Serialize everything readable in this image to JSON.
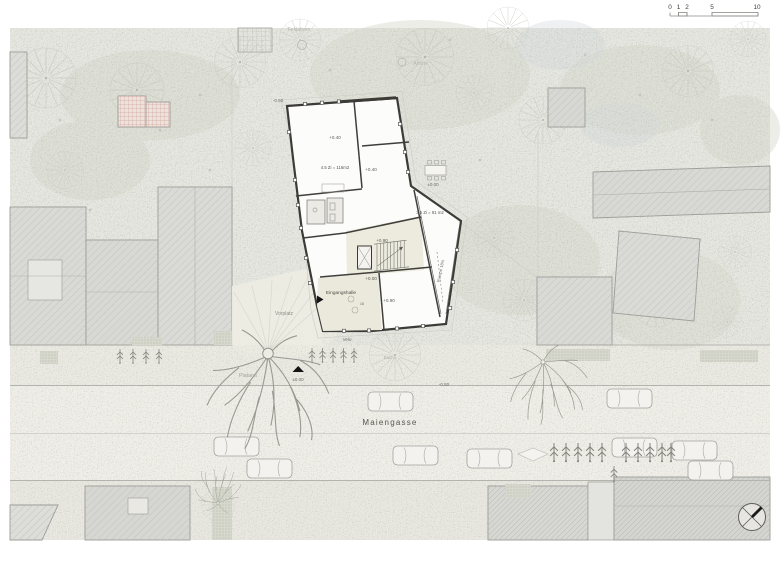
{
  "scale_bar": {
    "labels": [
      "0",
      "1",
      "2",
      "5",
      "10"
    ]
  },
  "plan": {
    "street_name": "Maiengasse",
    "tree_labels": {
      "feldahorn": "Feldahorn",
      "ahorn": "Ahorn",
      "buche": "Buche",
      "platane": "Platane"
    },
    "site_labels": {
      "vorplatz": "Vorplatz",
      "velo": "Velo"
    },
    "street_levels": {
      "north": "±0.00",
      "east": "-0.50"
    },
    "building": {
      "entrance_hall": "Eingangshalle",
      "ramp": "Rampe 18%",
      "apartment_45": "4.5 Zi = 116m2",
      "apartment_35": "3.5 Zi = 91 m2",
      "stair_count": "16",
      "levels": {
        "nw_corner": "-0.50",
        "upper_left": "+0.40",
        "upper_right": "+0.40",
        "terrace": "±0.00",
        "mid": "+0.90",
        "hall": "+0.00",
        "lower": "+0.90"
      }
    },
    "palette": {
      "paper": "#ffffff",
      "garden": "#e7e8e2",
      "sidewalk": "#ebeae3",
      "road": "#f0efe9",
      "existing_building": "#d8d9d4",
      "new_building_wall": "#3c3b37",
      "beige_interior": "#ebe9dc"
    }
  }
}
